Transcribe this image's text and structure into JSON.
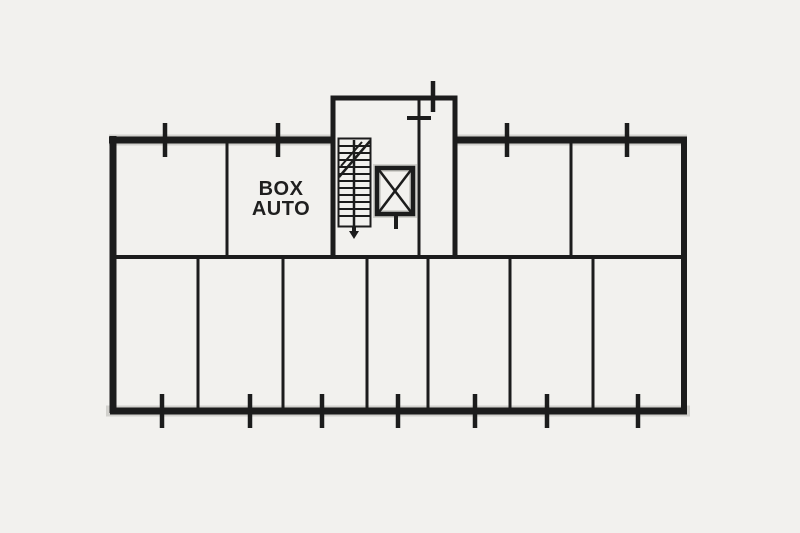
{
  "canvas": {
    "background": "#f2f1ee",
    "ink": "#1c1c1c",
    "text_color": "#1f1f1f"
  },
  "labels": {
    "box_auto_line1": "BOX",
    "box_auto_line2": "AUTO"
  },
  "symbols": {
    "stairs": "stairs-symbol",
    "stair_direction": "stair-direction-arrow",
    "elevator": "elevator-shaft-symbol",
    "wall_ticks": "wall-opening-tick"
  }
}
